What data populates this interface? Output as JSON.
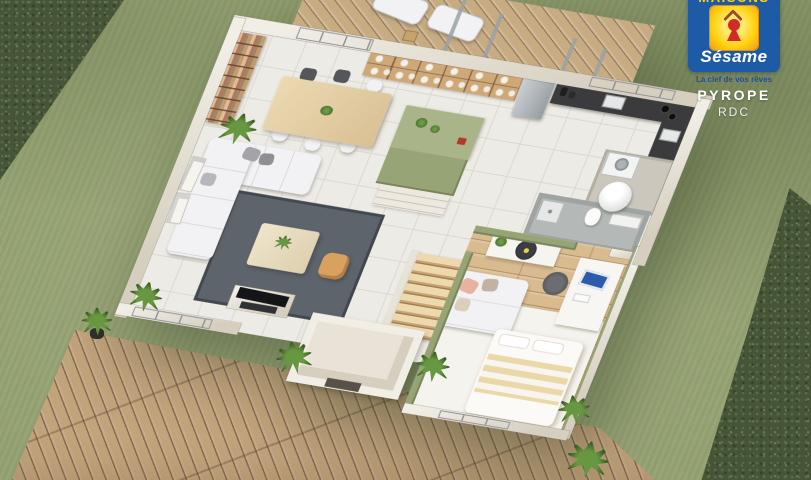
{
  "branding": {
    "brand_top": "MAISONS",
    "brand_name": "Sésame",
    "tagline": "La clef de vos rêves",
    "model_name": "PYROPE",
    "floor_label": "RDC"
  },
  "colors": {
    "logo_blue": "#1d5ba6",
    "logo_yellow": "#ffd20d",
    "logo_yellow_edge": "#f2991c",
    "keyhole_red": "#d22a26",
    "roof_chevron": "#9c4a28",
    "tagline_blue": "#1f4e9b",
    "grass": "#94a171",
    "hedge": "#465438",
    "deck_wood": "#c2a37c",
    "wall_beige": "#d6cfc0",
    "wall_top": "#f1eee6",
    "tile_floor": "#edebe5",
    "tile_line": "#dcd8cf",
    "accent_olive": "#97a475",
    "bedroom_wood": "#d9bb90",
    "rug_dark": "#5e646c",
    "sofa_white": "#f2f2f4",
    "counter_dark": "#3b3b3d",
    "pouf_orange": "#d9a160"
  }
}
